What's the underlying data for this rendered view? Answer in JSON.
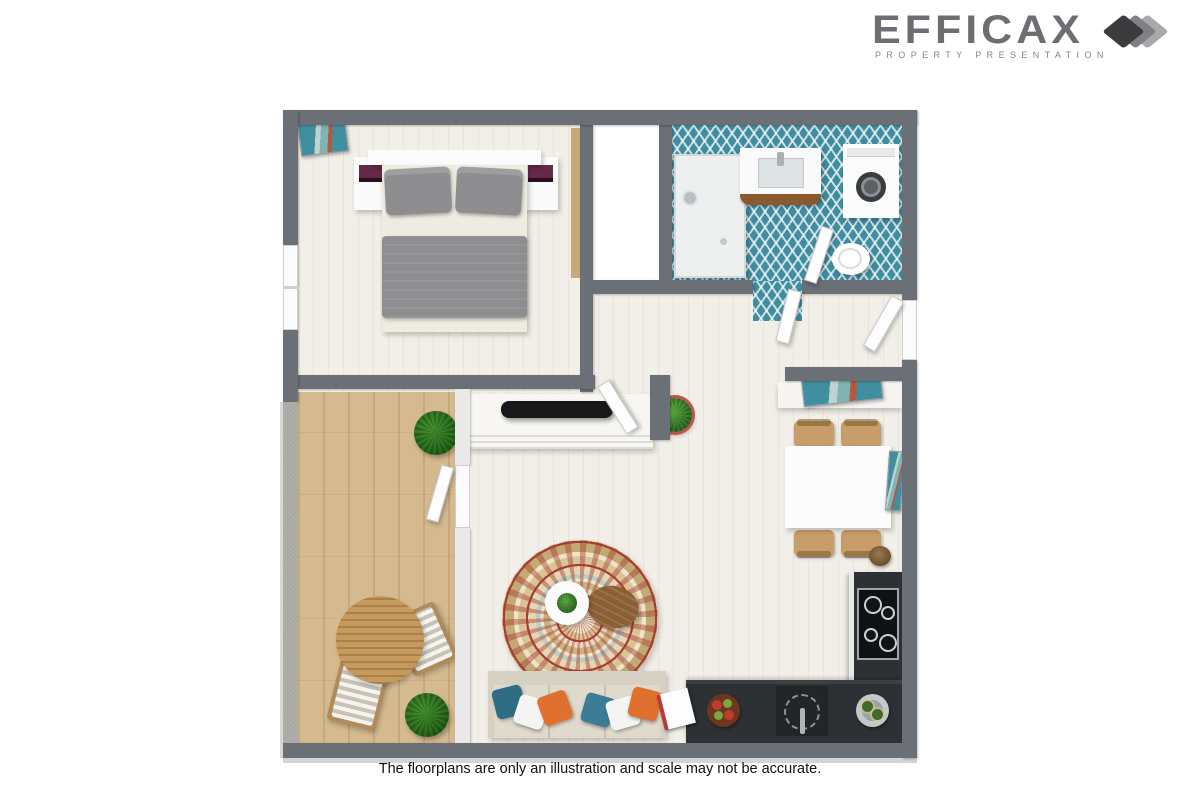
{
  "logo": {
    "brand": "EFFICAX",
    "tagline": "PROPERTY PRESENTATION",
    "icon": "layered-sheets-icon"
  },
  "footer": {
    "disclaimer": "The floorplans are only an illustration and scale may not be accurate."
  },
  "floorplan": {
    "type": "3d-top-view-floor-plan",
    "rooms": [
      {
        "name": "bedroom",
        "floor": "cream plank",
        "furniture": [
          "double bed with gray pillows and duvet",
          "left nightstand",
          "right nightstand",
          "wardrobe strip",
          "leaning wall art",
          "window"
        ]
      },
      {
        "name": "closet",
        "floor": "white"
      },
      {
        "name": "bathroom",
        "floor": "teal herringbone tile",
        "furniture": [
          "walk-in shower",
          "vanity sink with wood front",
          "washing machine",
          "toilet"
        ]
      },
      {
        "name": "living-room",
        "floor": "cream plank",
        "furniture": [
          "tv sideboard",
          "tv",
          "potted plant",
          "round patterned rug",
          "white round coffee table",
          "wood side table",
          "sofa with teal white and orange pillows"
        ]
      },
      {
        "name": "dining-area",
        "floor": "cream plank",
        "furniture": [
          "white dining table",
          "four tan chairs",
          "console with art",
          "wall art",
          "brown pot"
        ]
      },
      {
        "name": "kitchen",
        "floor": "cream plank",
        "furniture": [
          "l-shaped dark counter",
          "four-burner cooktop",
          "round sink",
          "fruit bowl",
          "cutting board",
          "ice bucket with bottles"
        ]
      },
      {
        "name": "balcony",
        "floor": "light oak wood",
        "furniture": [
          "round wood table",
          "two striped-cushion chairs",
          "two potted plants"
        ]
      }
    ]
  },
  "colors": {
    "wall-dark": "#6b7076",
    "wall-light": "#a9a8a3",
    "floor-cream": "#f1efe7",
    "floor-wood": "#d5ba90",
    "tile-teal": "#3f8da0",
    "counter-dark": "#2e3134",
    "sofa-beige": "#d7d1c3",
    "pillow-teal": "#2e6d84",
    "pillow-orange": "#e0702e",
    "pillow-white": "#f4f4f2",
    "bed-gray": "#8e8e90",
    "accent-purple": "#652a4a",
    "plant-green": "#3a7a2c",
    "pot-red": "#c0544d",
    "chair-tan": "#c79e69",
    "rug-red": "#a63f30",
    "logo-gray": "#6d6e71",
    "logo-dark": "#3b3b3d",
    "logo-mid": "#808184",
    "logo-light": "#a7a9ac",
    "text-dark": "#111111"
  }
}
